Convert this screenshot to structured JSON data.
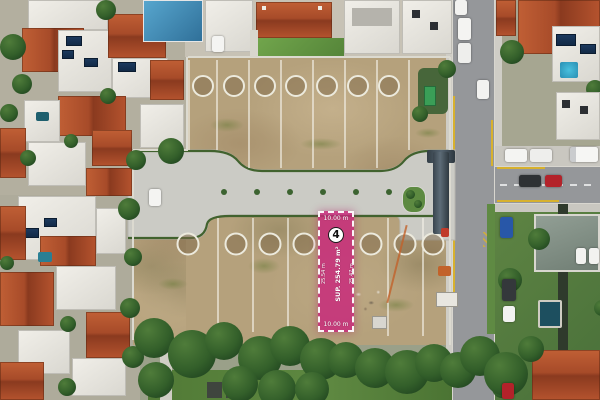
{
  "lot_overlay": {
    "number": "4",
    "dim_top": "10.00 m",
    "dim_bottom": "10.00 m",
    "dim_left": "25.54 m",
    "dim_right": "25.47 m",
    "area": "SUP. 254.79 m²",
    "highlight_color": "#c9327e"
  },
  "colors": {
    "dirt": "#b5a17c",
    "road_concrete": "#cbcbc5",
    "asphalt": "#95979a",
    "tree_green": "#2f5428",
    "roof_terracotta": "#a94b28"
  }
}
